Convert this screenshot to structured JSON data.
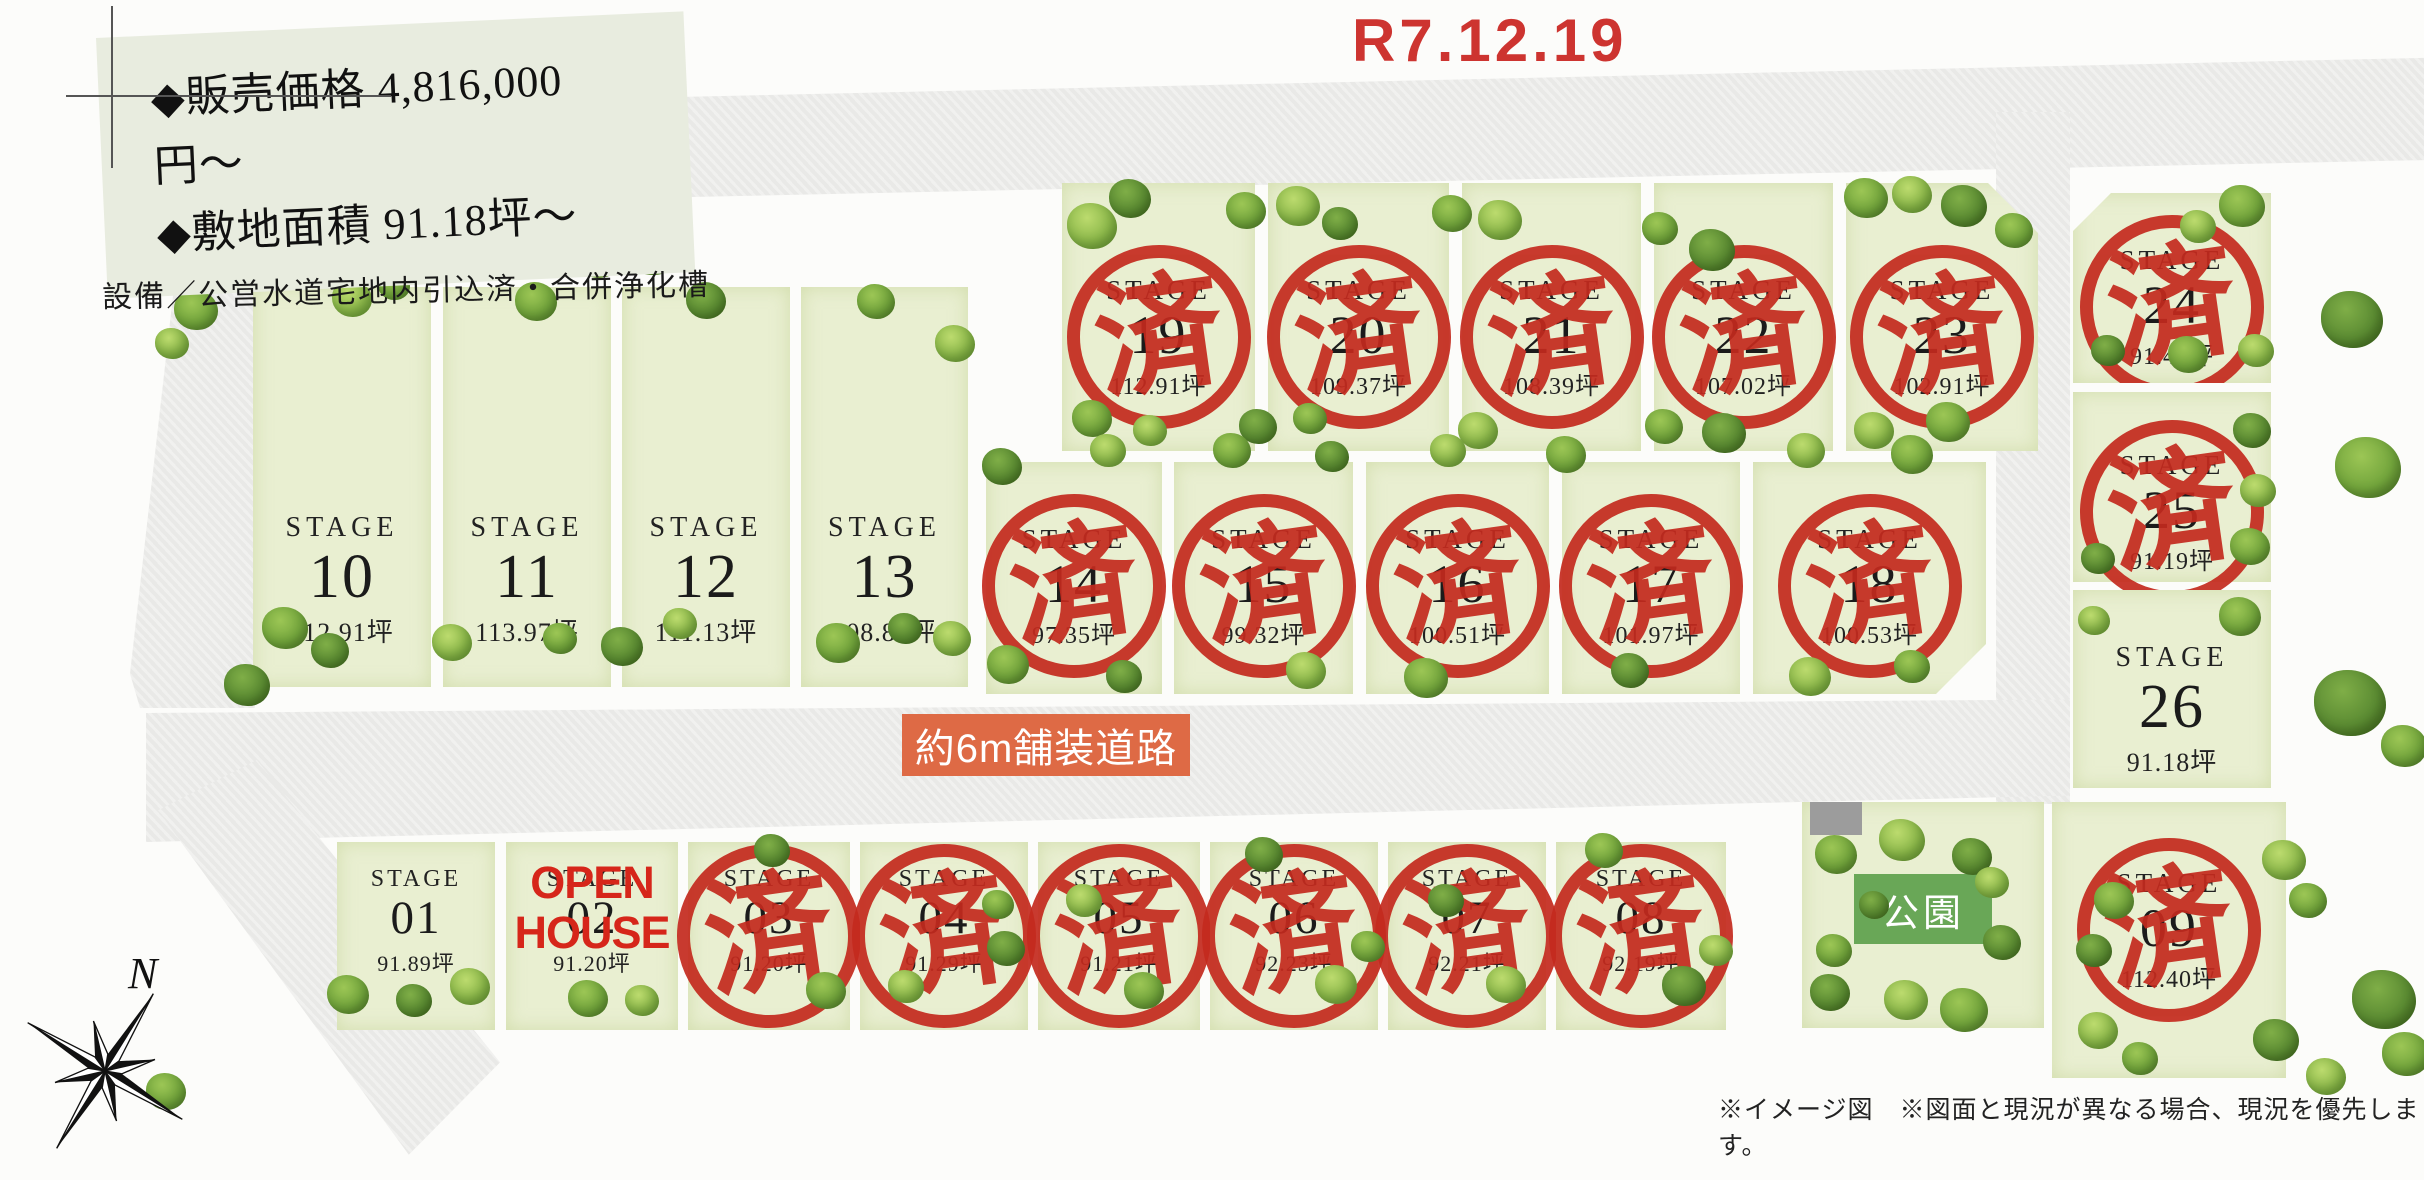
{
  "header": {
    "date": "R7.12.19"
  },
  "info_box": {
    "price_line": "◆販売価格 4,816,000円〜",
    "area_line": "◆敷地面積 91.18坪〜",
    "equipment_line": "設備／公営水道宅地内引込済・合併浄化槽"
  },
  "lot_word": "STAGE",
  "road_label": "約6m舗装道路",
  "park": {
    "label": "公園",
    "x": 1802,
    "y": 802,
    "w": 242,
    "h": 226
  },
  "stamp": {
    "char": "済",
    "meaning": "sold"
  },
  "open_house": {
    "line1": "OPEN",
    "line2": "HOUSE"
  },
  "compass": {
    "label": "N"
  },
  "disclaimer": "※イメージ図　※図面と現況が異なる場合、現況を優先します。",
  "colors": {
    "stamp_red": "#c42a1e",
    "date_red": "#cd3430",
    "road_label_orange": "#de6a45",
    "park_green": "#69a757",
    "lot_green": "#e9efd1"
  },
  "lots": [
    {
      "num": "01",
      "area": "91.89坪",
      "status": "available",
      "x": 337,
      "y": 842,
      "w": 158,
      "h": 188,
      "ly": 24,
      "sz": "sm"
    },
    {
      "num": "02",
      "area": "91.20坪",
      "status": "open_house",
      "x": 506,
      "y": 842,
      "w": 172,
      "h": 188,
      "ly": 24,
      "sz": "sm"
    },
    {
      "num": "03",
      "area": "91.20坪",
      "status": "sold",
      "x": 688,
      "y": 842,
      "w": 162,
      "h": 188,
      "ly": 24,
      "sz": "sm"
    },
    {
      "num": "04",
      "area": "91.29坪",
      "status": "sold",
      "x": 860,
      "y": 842,
      "w": 168,
      "h": 188,
      "ly": 24,
      "sz": "sm"
    },
    {
      "num": "05",
      "area": "91.21坪",
      "status": "sold",
      "x": 1038,
      "y": 842,
      "w": 162,
      "h": 188,
      "ly": 24,
      "sz": "sm"
    },
    {
      "num": "06",
      "area": "92.23坪",
      "status": "sold",
      "x": 1210,
      "y": 842,
      "w": 168,
      "h": 188,
      "ly": 24,
      "sz": "sm"
    },
    {
      "num": "07",
      "area": "92.21坪",
      "status": "sold",
      "x": 1388,
      "y": 842,
      "w": 158,
      "h": 188,
      "ly": 24,
      "sz": "sm"
    },
    {
      "num": "08",
      "area": "92.19坪",
      "status": "sold",
      "x": 1556,
      "y": 842,
      "w": 170,
      "h": 188,
      "ly": 24,
      "sz": "sm"
    },
    {
      "num": "09",
      "area": "112.40坪",
      "status": "sold",
      "x": 2052,
      "y": 802,
      "w": 234,
      "h": 276,
      "ly": 66,
      "sz": "md"
    },
    {
      "num": "10",
      "area": "112.91坪",
      "status": "available",
      "x": 253,
      "y": 287,
      "w": 178,
      "h": 400,
      "ly": 225,
      "sz": "lg"
    },
    {
      "num": "11",
      "area": "113.97坪",
      "status": "available",
      "x": 443,
      "y": 287,
      "w": 168,
      "h": 400,
      "ly": 225,
      "sz": "lg"
    },
    {
      "num": "12",
      "area": "111.13坪",
      "status": "available",
      "x": 622,
      "y": 287,
      "w": 168,
      "h": 400,
      "ly": 225,
      "sz": "lg"
    },
    {
      "num": "13",
      "area": "108.84坪",
      "status": "available",
      "x": 801,
      "y": 287,
      "w": 167,
      "h": 400,
      "ly": 225,
      "sz": "lg"
    },
    {
      "num": "14",
      "area": "97.35坪",
      "status": "sold",
      "x": 986,
      "y": 462,
      "w": 176,
      "h": 232,
      "ly": 62,
      "sz": "md"
    },
    {
      "num": "15",
      "area": "99.32坪",
      "status": "sold",
      "x": 1174,
      "y": 462,
      "w": 179,
      "h": 232,
      "ly": 62,
      "sz": "md"
    },
    {
      "num": "16",
      "area": "100.51坪",
      "status": "sold",
      "x": 1366,
      "y": 462,
      "w": 183,
      "h": 232,
      "ly": 62,
      "sz": "md"
    },
    {
      "num": "17",
      "area": "101.97坪",
      "status": "sold",
      "x": 1562,
      "y": 462,
      "w": 178,
      "h": 232,
      "ly": 62,
      "sz": "md"
    },
    {
      "num": "18",
      "area": "100.53坪",
      "status": "sold",
      "x": 1753,
      "y": 462,
      "w": 233,
      "h": 232,
      "ly": 62,
      "sz": "md",
      "clip": "br"
    },
    {
      "num": "19",
      "area": "112.91坪",
      "status": "sold",
      "x": 1062,
      "y": 183,
      "w": 193,
      "h": 268,
      "ly": 92,
      "sz": "md"
    },
    {
      "num": "20",
      "area": "109.37坪",
      "status": "sold",
      "x": 1268,
      "y": 183,
      "w": 181,
      "h": 268,
      "ly": 92,
      "sz": "md"
    },
    {
      "num": "21",
      "area": "108.39坪",
      "status": "sold",
      "x": 1462,
      "y": 183,
      "w": 179,
      "h": 268,
      "ly": 92,
      "sz": "md"
    },
    {
      "num": "22",
      "area": "107.02坪",
      "status": "sold",
      "x": 1654,
      "y": 183,
      "w": 179,
      "h": 268,
      "ly": 92,
      "sz": "md"
    },
    {
      "num": "23",
      "area": "102.91坪",
      "status": "sold",
      "x": 1846,
      "y": 183,
      "w": 192,
      "h": 268,
      "ly": 92,
      "sz": "md",
      "clip": "tr"
    },
    {
      "num": "24",
      "area": "91.42坪",
      "status": "sold",
      "x": 2073,
      "y": 193,
      "w": 198,
      "h": 190,
      "ly": 52,
      "sz": "md",
      "clip": "tl"
    },
    {
      "num": "25",
      "area": "91.19坪",
      "status": "sold",
      "x": 2073,
      "y": 392,
      "w": 198,
      "h": 190,
      "ly": 58,
      "sz": "md"
    },
    {
      "num": "26",
      "area": "91.18坪",
      "status": "available",
      "x": 2073,
      "y": 590,
      "w": 198,
      "h": 198,
      "ly": 52,
      "sz": "lg"
    }
  ]
}
